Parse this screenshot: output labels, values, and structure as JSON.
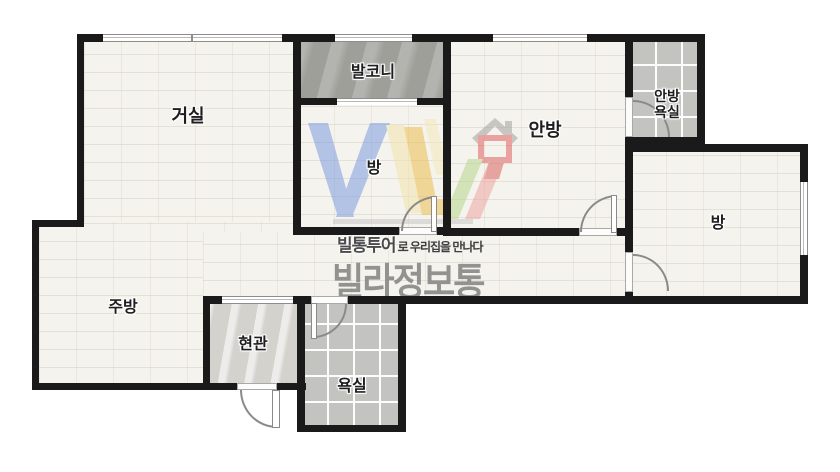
{
  "rooms": {
    "living": {
      "label": "거실"
    },
    "balcony": {
      "label": "발코니"
    },
    "room_center": {
      "label": "방"
    },
    "master": {
      "label": "안방"
    },
    "master_bath": {
      "line1": "안방",
      "line2": "욕실"
    },
    "room_right": {
      "label": "방"
    },
    "kitchen": {
      "label": "주방"
    },
    "entrance": {
      "label": "현관"
    },
    "bathroom": {
      "label": "욕실"
    }
  },
  "watermark": {
    "tagline_bold": "빌통투어",
    "tagline_rest": "로 우리집을 만나다",
    "brand": "빌라정보통"
  },
  "colors": {
    "wall": "#1a1a1a",
    "floor": "#f5f3ee",
    "tile": "#c3c3c0",
    "balcony_floor": "#a9a9a4",
    "entry_floor": "#dcdad6",
    "logo_blue": "#a3b8e6",
    "logo_yellow": "#ecc050",
    "logo_green": "#b7d78c",
    "logo_red": "#e0605f",
    "logo_pink": "#eca5a3",
    "watermark_gray": "#7d7d7d"
  }
}
